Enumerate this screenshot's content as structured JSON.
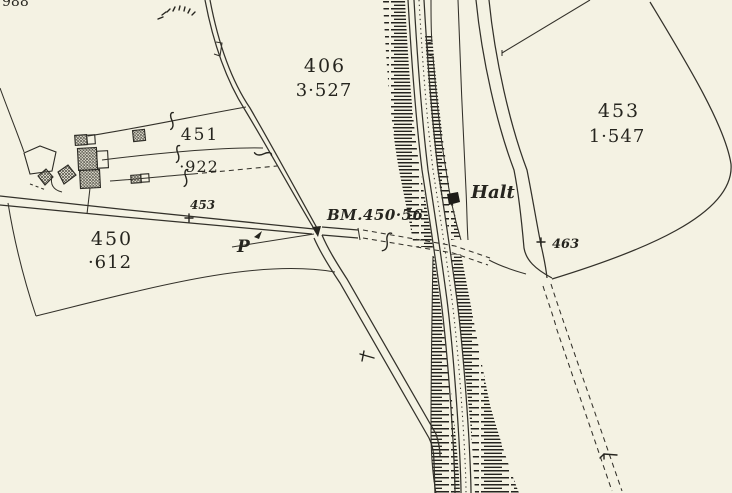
{
  "map": {
    "colors": {
      "paper": "#f4f2e3",
      "ink": "#33312a",
      "text_ink": "#26251f"
    },
    "parcels": {
      "p406": {
        "number": "406",
        "acreage": "3·527"
      },
      "p451": {
        "number": "451",
        "acreage": "·922"
      },
      "p450": {
        "number": "450",
        "acreage": "·612"
      },
      "p453_east": {
        "number": "453",
        "acreage": "1·547"
      }
    },
    "annotations": {
      "halt": "Halt",
      "benchmark": "BM.450·56",
      "road_parcel_number": "453",
      "spot_number": "463",
      "post_letter": "P",
      "edge_clipped_number": "988"
    }
  }
}
